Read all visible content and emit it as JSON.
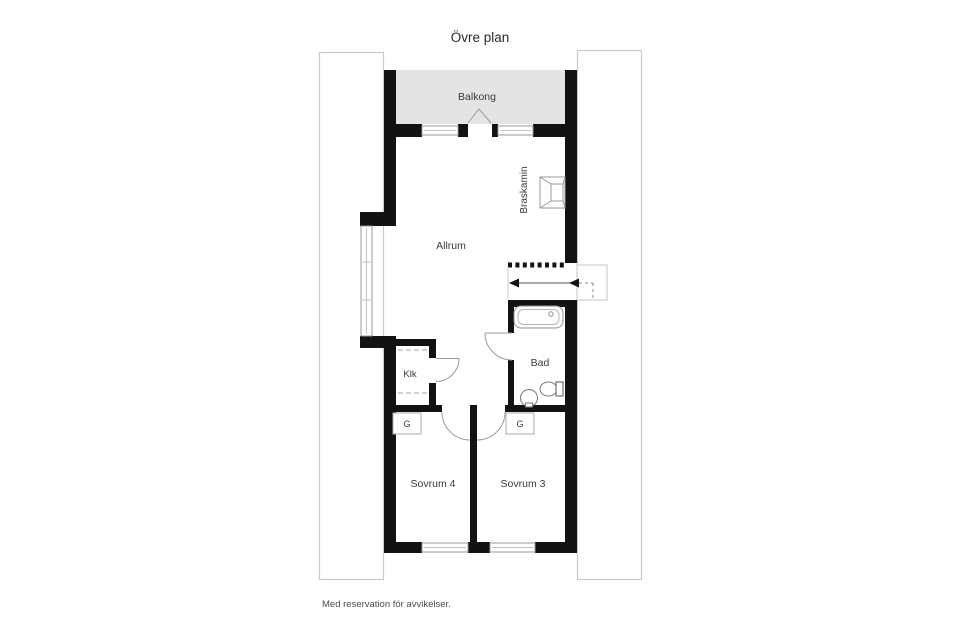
{
  "header": {
    "title": "Övre plan"
  },
  "labels": {
    "balcony": "Balkong",
    "living_room": "Allrum",
    "fireplace": "Braskamin",
    "bathroom": "Bad",
    "walk_in_closet": "Klk",
    "bedroom_4": "Sovrum 4",
    "bedroom_3": "Sovrum 3",
    "wardrobe_bedroom4": "G",
    "wardrobe_bedroom3": "G"
  },
  "footer": {
    "disclaimer": "Med reservation för avvikelser."
  },
  "colors": {
    "wall": "#121212",
    "balcony_fill": "#e4e4e4",
    "panel_stroke": "#c9c9c9",
    "fixture_stroke": "#8f8f8f",
    "label_text": "#3a3a3a"
  }
}
